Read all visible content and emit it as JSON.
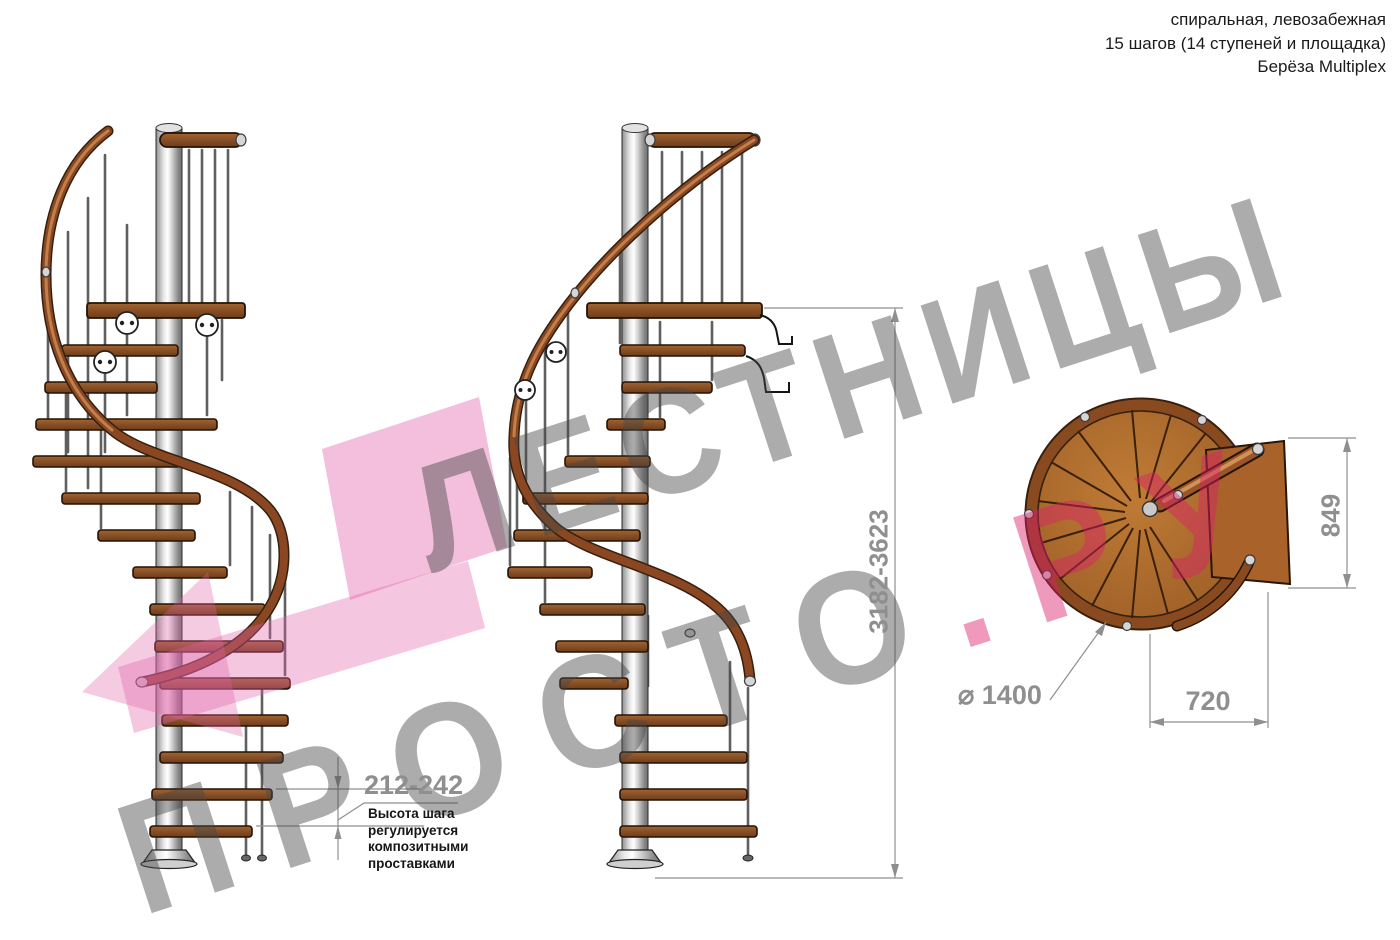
{
  "header": {
    "line1": "спиральная, левозабежная",
    "line2": "15 шагов (14 ступеней и площадка)",
    "line3": "Берёза Multiplex"
  },
  "watermark": {
    "line1": "ЛЕСТНИЦЫ",
    "line2_gray": "ПРОСТО",
    "line2_pink": ".РУ"
  },
  "dimensions": {
    "total_height": "3182-3623",
    "step_height": "212-242",
    "note_lines": [
      "Высота шага",
      "регулируется",
      "композитными",
      "проставками"
    ],
    "diameter_symbol": "⌀",
    "diameter_value": "1400",
    "plan_width": "720",
    "plan_depth": "849"
  },
  "colors": {
    "watermark_pink": "#e260a8",
    "watermark_gray": "#a3a3a3",
    "dimension_gray": "#8f8f8f",
    "wood": "#8a5128",
    "handrail": "#7d3f1c",
    "pole": "#d9d9d9",
    "text": "#1a1a1a"
  }
}
